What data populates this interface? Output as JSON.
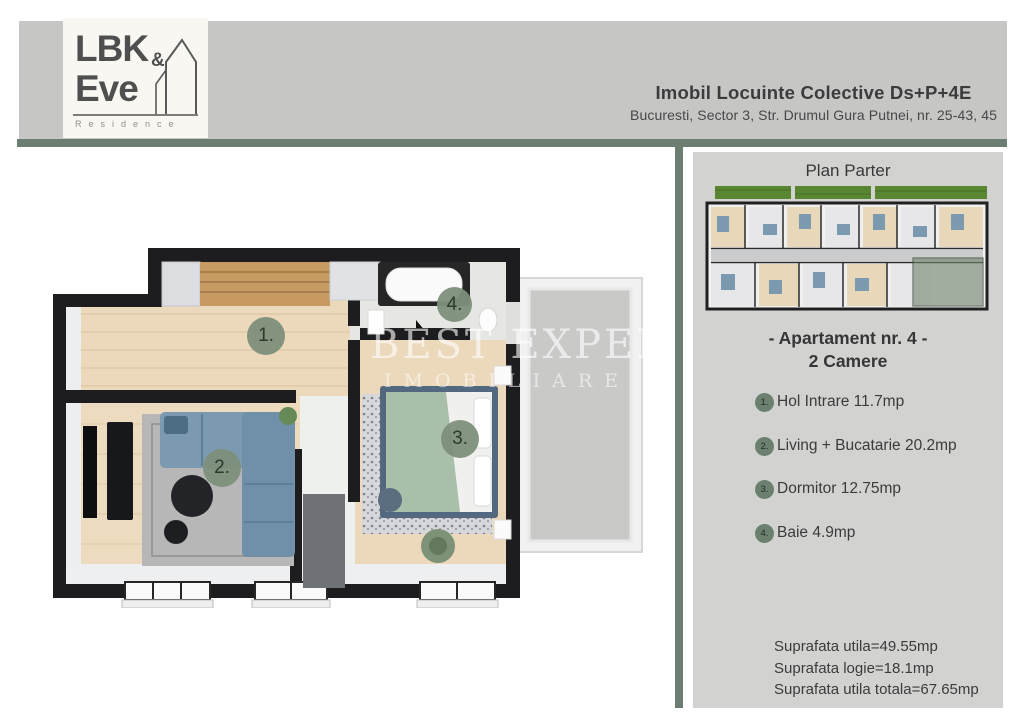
{
  "header": {
    "logo": {
      "word1": "LBK",
      "amp": "&",
      "word2": "Eve",
      "subtitle": "Residence"
    },
    "title": "Imobil Locuinte Colective Ds+P+4E",
    "address": "Bucuresti, Sector 3, Str. Drumul Gura Putnei, nr. 25-43, 45"
  },
  "watermark": {
    "line1": "BEST EXPERT",
    "line2": "IMOBILIARE"
  },
  "plan": {
    "badges": [
      "1.",
      "2.",
      "3.",
      "4."
    ]
  },
  "sidebar": {
    "plan_title": "Plan Parter",
    "apartment_title": "- Apartament nr. 4 -",
    "apartment_subtitle": "2 Camere",
    "rooms": [
      {
        "num": "1.",
        "label": "Hol Intrare 11.7mp"
      },
      {
        "num": "2.",
        "label": "Living + Bucatarie 20.2mp"
      },
      {
        "num": "3.",
        "label": "Dormitor 12.75mp"
      },
      {
        "num": "4.",
        "label": "Baie 4.9mp"
      }
    ],
    "totals": [
      "Suprafata utila=49.55mp",
      "Suprafata logie=18.1mp",
      "Suprafata utila totala=67.65mp"
    ]
  },
  "colors": {
    "header_band": "#c6c7c5",
    "divider_green": "#6d7d72",
    "sidebar_bg": "#d2d3d1",
    "badge_green": "#7d8f7a",
    "grass_green": "#588631",
    "highlight_green": "#72876f",
    "wall_black": "#1d1d1f",
    "wood_floor": "#ecd8ba"
  }
}
